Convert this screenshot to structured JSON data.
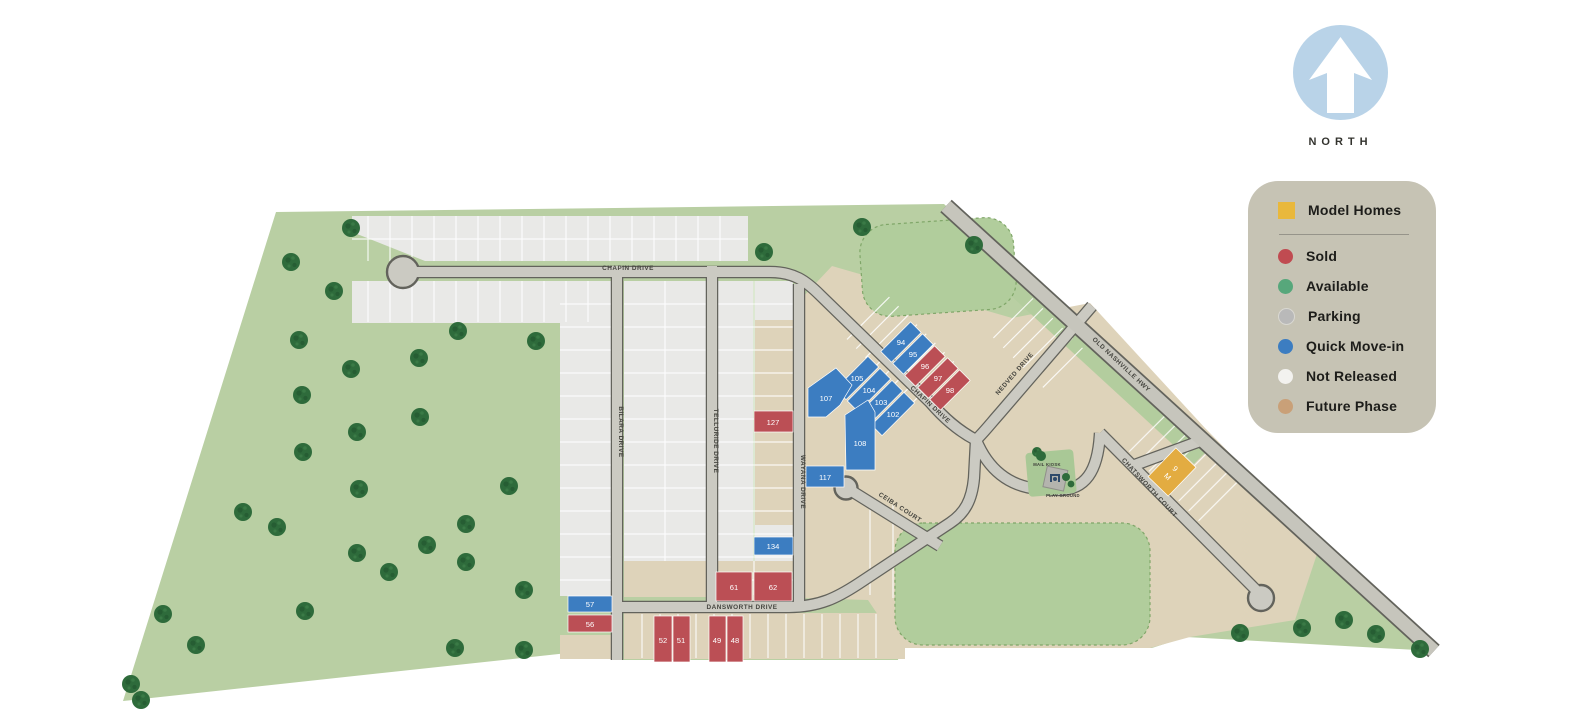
{
  "north": {
    "label": "NORTH"
  },
  "legend": {
    "model": {
      "label": "Model Homes",
      "color": "#e9b83c"
    },
    "items": [
      {
        "label": "Sold",
        "color": "#c04b51"
      },
      {
        "label": "Available",
        "color": "#57a77b"
      },
      {
        "label": "Parking",
        "color": "#b9b9b9"
      },
      {
        "label": "Quick Move-in",
        "color": "#3c7dc1"
      },
      {
        "label": "Not Released",
        "color": "#f3f2ef"
      },
      {
        "label": "Future Phase",
        "color": "#c9a078"
      }
    ]
  },
  "streets": {
    "chapin": "CHAPIN DRIVE",
    "bilara": "BILARA DRIVE",
    "telluride": "TELLURIDE DRIVE",
    "wayana": "WAYANA DRIVE",
    "dansworth": "DANSWORTH DRIVE",
    "ceiba": "CEIBA COURT",
    "nedved": "NEDVED DRIVE",
    "chatsworth": "CHATSWORTH COURT",
    "old_nashville": "OLD NASHVILLE HWY"
  },
  "pois": {
    "mail_kiosk": "MAIL KIOSK",
    "play_ground": "PLAY GROUND"
  },
  "lots": {
    "l94": "94",
    "l95": "95",
    "l96": "96",
    "l97": "97",
    "l98": "98",
    "l102": "102",
    "l103": "103",
    "l104": "104",
    "l105": "105",
    "l107": "107",
    "l108": "108",
    "l117": "117",
    "l127": "127",
    "l134": "134",
    "l57": "57",
    "l56": "56",
    "l61": "61",
    "l62": "62",
    "l52": "52",
    "l51": "51",
    "l49": "49",
    "l48": "48",
    "model_number": "9",
    "model_letter": "M"
  },
  "colors": {
    "site_green": "#b9cfa3",
    "open_space_green": "#b1cd9c",
    "tree_green": "#2e6b3b",
    "not_released_gray": "#e9e9e7",
    "future_phase_tan": "#ded3ba",
    "road_gray": "#cbcac2",
    "road_edge": "#63635c",
    "sold_red": "#bb4f55",
    "quick_move_in_blue": "#3c7dc1",
    "model_yellow": "#e3ac41",
    "north_circle_blue": "#b9d3e8",
    "legend_bg": "#c6c3b4"
  }
}
